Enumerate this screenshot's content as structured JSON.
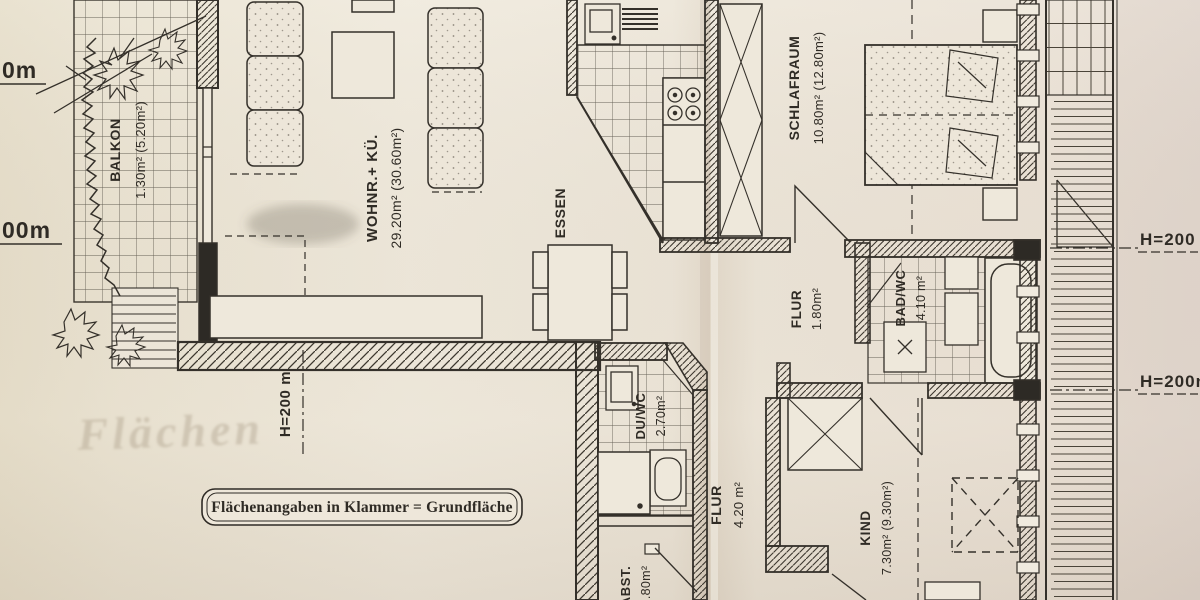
{
  "document": {
    "kind": "apartment floor plan scan",
    "legend": {
      "note": "Flächenangaben in Klammer = Grundfläche"
    },
    "watermark": {
      "text": "Flächen"
    }
  },
  "rooms": {
    "balkon": {
      "name": "BALKON",
      "area": "1.30m² (5.20m²)"
    },
    "wohnkueche": {
      "name": "WOHNR.+ KÜ.",
      "area": "29.20m² (30.60m²)"
    },
    "essen": {
      "name": "ESSEN"
    },
    "schlafraum": {
      "name": "SCHLAFRAUM",
      "area": "10.80m² (12.80m²)"
    },
    "flur_klein": {
      "name": "FLUR",
      "area": "1.80m²"
    },
    "bad_wc": {
      "name": "BAD/WC",
      "area": "4.10 m²"
    },
    "du_wc": {
      "name": "DU/WC",
      "area": "2.70m²"
    },
    "flur_gross": {
      "name": "FLUR",
      "area": "4.20 m²"
    },
    "kind": {
      "name": "KIND",
      "area": "7.30m² (9.30m²)"
    },
    "abstellraum": {
      "name": "ABST.",
      "area": "1.80m²"
    }
  },
  "height_marks": {
    "left_top": "0m",
    "left_mid": "00m",
    "center": "H=200 m",
    "right_top": "H=200",
    "right_bottom": "H=200m"
  }
}
